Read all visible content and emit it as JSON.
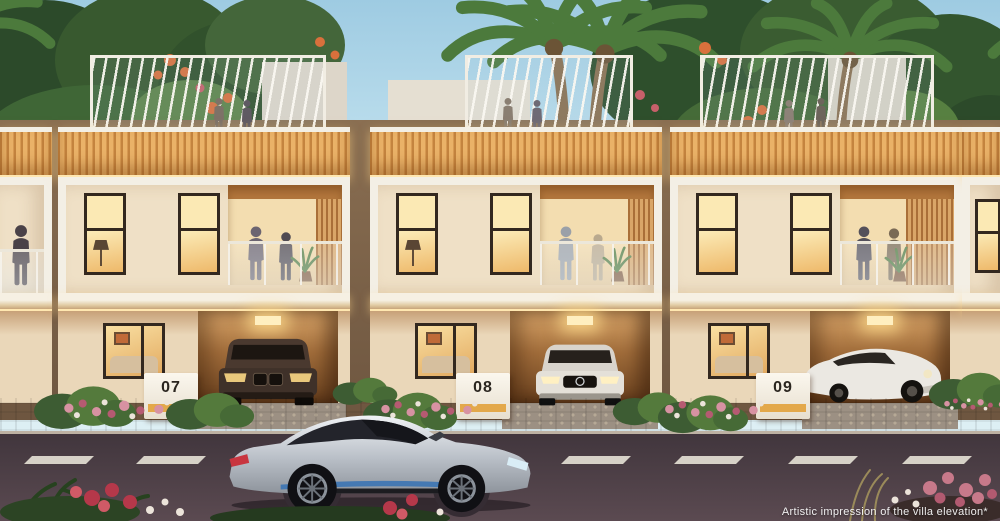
{
  "caption": "Artistic impression of the villa elevation*",
  "villas": [
    {
      "number": "07",
      "car": "dark-bronze-suv"
    },
    {
      "number": "08",
      "car": "silver-sedan"
    },
    {
      "number": "09",
      "car": "white-coupe"
    }
  ],
  "foreground_car": "silver-sports-coupe",
  "colors": {
    "sky_top": "#9ecbe2",
    "sky_horizon": "#ddeff4",
    "wall": "#efe0c6",
    "wall_ground": "#ead7b9",
    "frame_white": "#f3efe5",
    "wood": "#eab268",
    "glow": "#ffe7b0",
    "window_glass": "#eeb96a",
    "accent_amber": "#e2a33e",
    "plinth": "#f8f4ea",
    "number_ink": "#2b2620",
    "road": "#5b4a51",
    "lane": "#e3ded2",
    "pavement": "#a79b8e",
    "foliage": "#3f6636"
  }
}
